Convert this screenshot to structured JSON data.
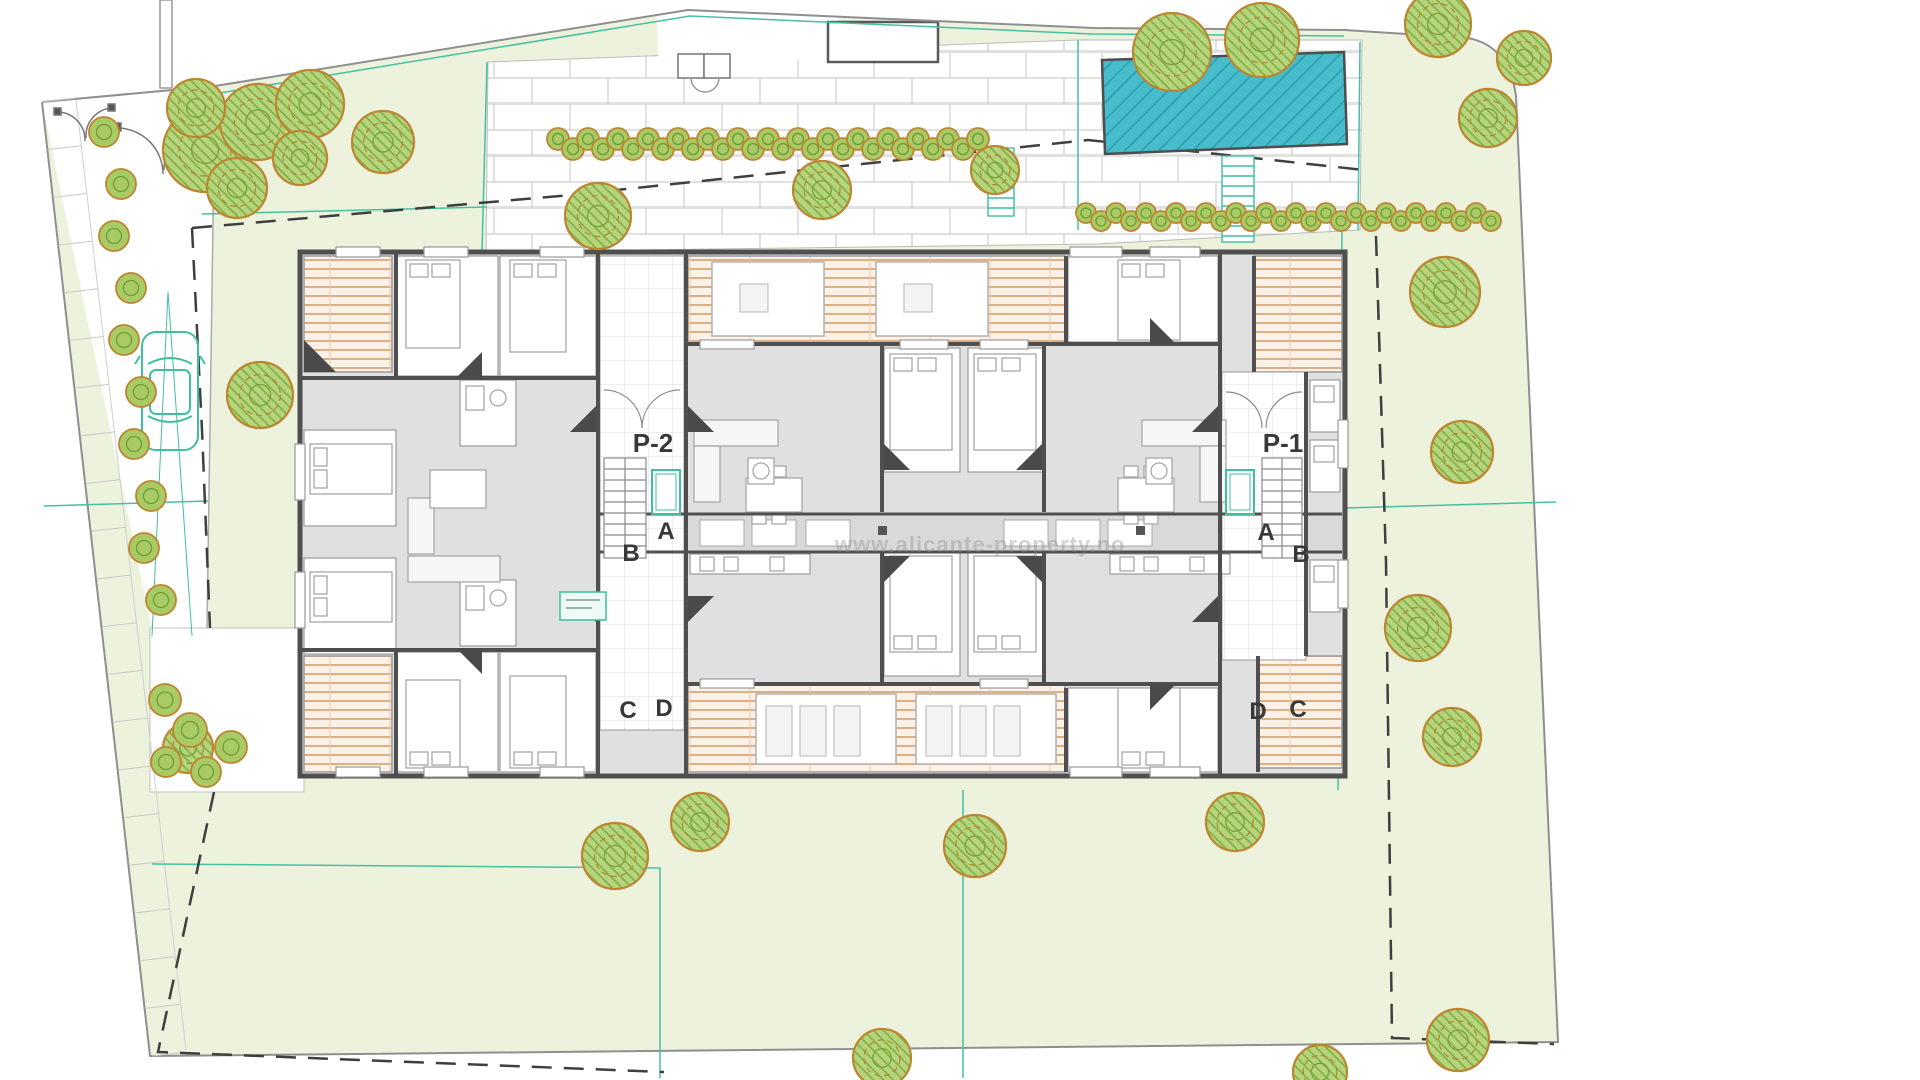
{
  "plan_labels": {
    "core_left": {
      "stair": "P-2",
      "a": "A",
      "b": "B",
      "c": "C",
      "d": "D"
    },
    "core_right": {
      "stair": "P-1",
      "a": "A",
      "b": "B",
      "c": "C",
      "d": "D"
    }
  },
  "watermark": {
    "text": "www.alicante-property.no"
  },
  "colors": {
    "lawn": "#edf2dc",
    "paving_joint": "#cfcfcf",
    "pool_water": "#47bcca",
    "pool_hatch": "#2d9fae",
    "wall": "#4f4f4f",
    "room_fill": "#e0e0e0",
    "terrace_stripe": "#d29a67",
    "tree_outline": "#bd8530",
    "tree_fill": "#a9cb66",
    "accent_teal": "#3fbf9f",
    "dashed_line": "#3f3f3f",
    "label_text": "#383838"
  }
}
